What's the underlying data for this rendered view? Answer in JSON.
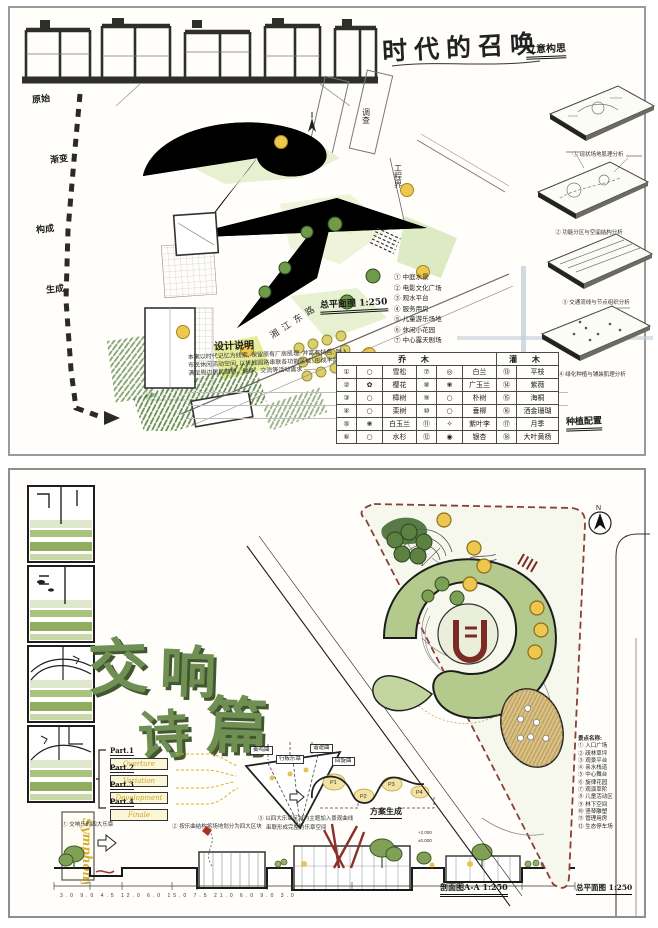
{
  "colors": {
    "leaf_dark": "#3f6b2f",
    "leaf": "#7ba054",
    "accent_yellow": "#edc74e",
    "ink": "#1a1a1a",
    "red_border": "#8a4038",
    "title_green": "#6f8f53"
  },
  "top_panel": {
    "title": "时代的召唤",
    "subtitle": "立意构思",
    "boundary_labels": {
      "survey": "调查",
      "limit": "工程界"
    },
    "process_labels": [
      "原始",
      "渐变",
      "构成",
      "生成"
    ],
    "plan_scale": "总平面图 1:250",
    "road_name": "湘江东路",
    "notes": {
      "title": "设计说明",
      "lines": [
        "本案以时代记忆为线索, 保留原有厂房肌理, 并富有特色, 融入",
        "市民休闲活动空间, 以折线园路串联各功能区域, 形成丰富的景观层次,",
        "满足周边居民游憩、健身、交流等活动需求 ——"
      ]
    },
    "features": [
      "① 中庭水景",
      "② 电影文化广场",
      "③ 观水平台",
      "④ 服务用房",
      "⑤ 儿童游乐场地",
      "⑥ 休闲小花园",
      "⑦ 中心露天剧场"
    ],
    "analysis": [
      {
        "caption": "① 现状场地肌理分析"
      },
      {
        "caption": "② 功能分区与空间结构分析"
      },
      {
        "caption": "③ 交通流线与节点组织分析"
      },
      {
        "caption": "④ 绿化种植与铺装肌理分析"
      }
    ],
    "legend": {
      "header_tree": "乔  木",
      "header_shrub": "灌  木",
      "rows": [
        [
          "①",
          "○",
          "雪松",
          "⑦",
          "◎",
          "白兰",
          "⑬",
          "平枝"
        ],
        [
          "②",
          "✿",
          "樱花",
          "⑧",
          "❀",
          "广玉兰",
          "⑭",
          "紫薇"
        ],
        [
          "③",
          "○",
          "樟树",
          "⑨",
          "○",
          "朴树",
          "⑮",
          "海桐"
        ],
        [
          "④",
          "○",
          "栾树",
          "⑩",
          "○",
          "垂柳",
          "⑯",
          "洒金珊瑚"
        ],
        [
          "⑤",
          "❀",
          "白玉兰",
          "⑪",
          "✧",
          "紫叶李",
          "⑰",
          "月季"
        ],
        [
          "⑥",
          "○",
          "水杉",
          "⑫",
          "◉",
          "银杏",
          "⑱",
          "大叶黄杨"
        ]
      ],
      "footer": "种植配置"
    }
  },
  "bottom_panel": {
    "title_chars": [
      "交",
      "响",
      "诗",
      "篇"
    ],
    "symphony": "Symphony",
    "north": "N",
    "parts": [
      {
        "label": "Part.1",
        "word": "Overture"
      },
      {
        "label": "Part.2",
        "word": "Variation"
      },
      {
        "label": "Part.3",
        "word": "Development"
      },
      {
        "label": "Part.4",
        "word": "Finale"
      }
    ],
    "movement_boxes": [
      "奏鸣曲",
      "行板乐章",
      "谐谑曲",
      "回旋曲"
    ],
    "curve_labels": [
      "P1",
      "P2",
      "P3",
      "P4"
    ],
    "captions": [
      "① 交响乐的四大乐章",
      "② 按乐曲结构将场地划分为四大区块",
      "③ 以四大乐章区域为主题加入景观曲线",
      "串联形成完整的乐章空间"
    ],
    "scheme_label": "方案生成",
    "section": {
      "caption": "剖面图A-A 1:250",
      "elev_upper": "+2.000",
      "elev_lower": "±0.000",
      "dims": "3.0  9.0  4.5  12.0  6.0  15.0  7.5  21.0  6.0  9.0  3.0"
    },
    "plan_caption": "总平面图 1:250",
    "spots": {
      "title": "景点名称:",
      "items": [
        "① 入口广场",
        "② 疏林草坪",
        "③ 观景平台",
        "④ 亲水栈道",
        "⑤ 中心舞台",
        "⑥ 旋律花园",
        "⑦ 观演草阶",
        "⑧ 儿童活动区",
        "⑨ 林下空间",
        "⑩ 竖琴雕塑",
        "⑪ 管理用房",
        "⑫ 生态停车场"
      ]
    }
  }
}
